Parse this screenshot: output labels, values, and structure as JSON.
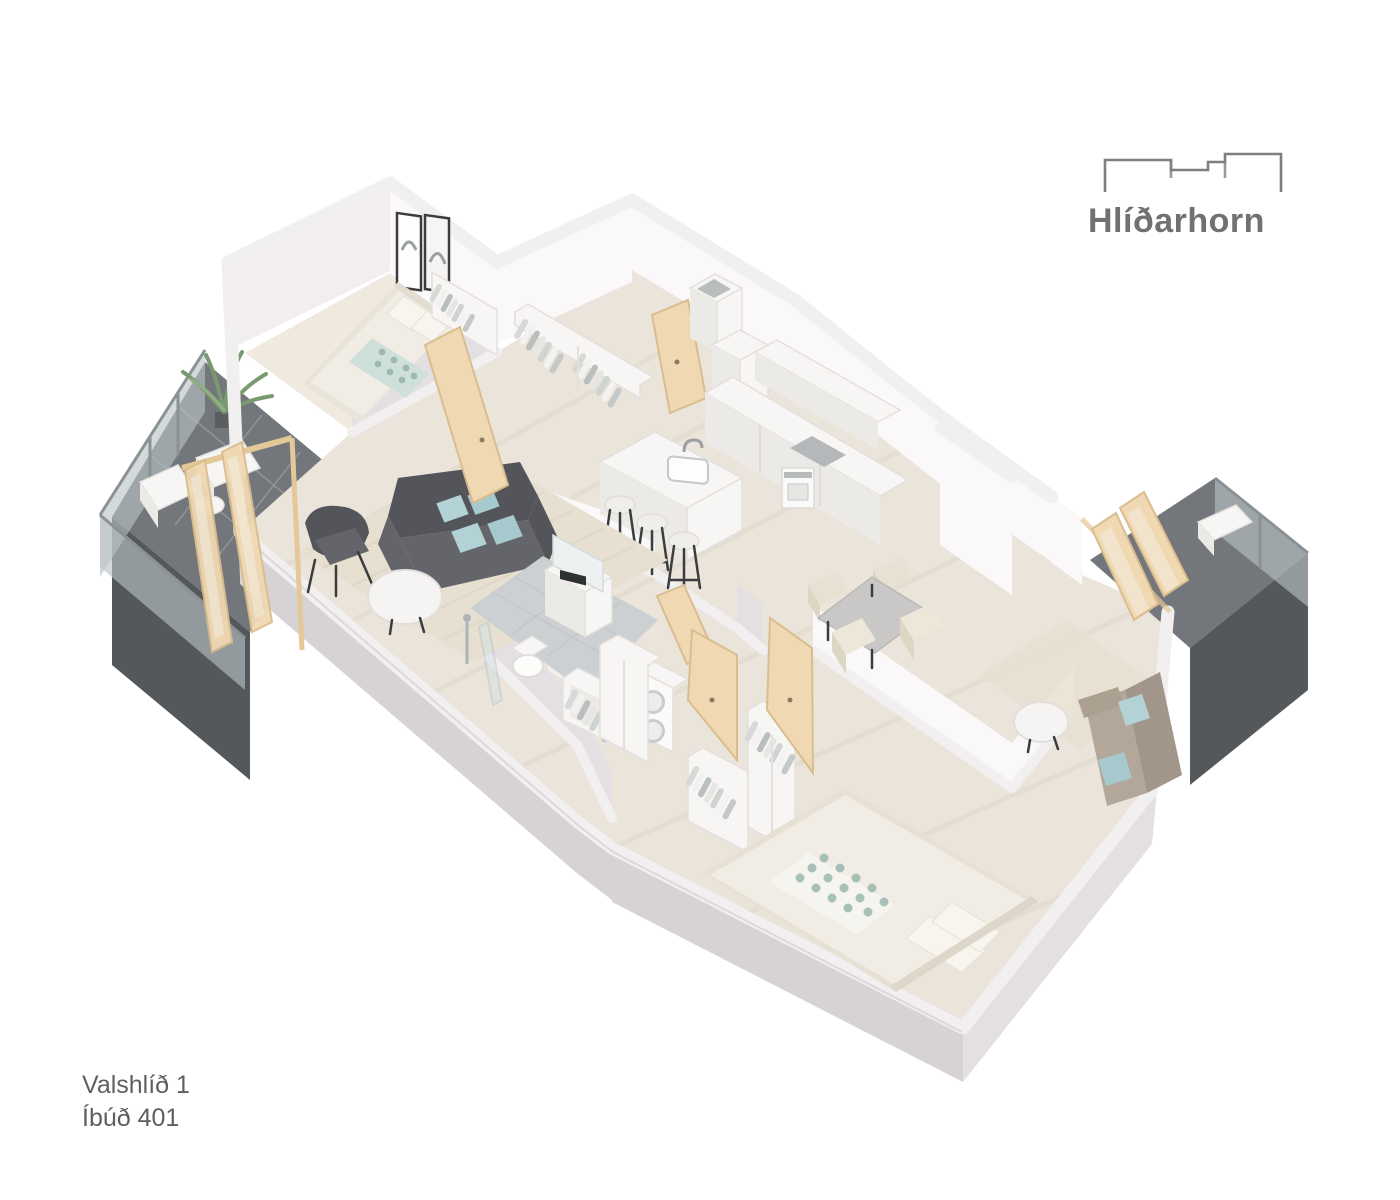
{
  "logo": {
    "brand": "Hlíðarhorn"
  },
  "labels": {
    "project": "Valshlíð 1",
    "unit": "Íbúð 401"
  },
  "plan": {
    "type": "3d-isometric-floor-plan",
    "rooms": [
      "bedroom-1",
      "entry-hall",
      "kitchen",
      "living-room",
      "bathroom",
      "laundry",
      "dining-area",
      "sitting-nook",
      "bedroom-2",
      "balcony-west",
      "balcony-east"
    ],
    "furniture": [
      "double-bed",
      "wall-art",
      "wardrobe",
      "hall-closet",
      "sofa",
      "armchair",
      "coffee-table",
      "area-rug",
      "kitchen-island",
      "sink",
      "bar-stools",
      "counter",
      "oven",
      "cooktop",
      "tall-cabinet",
      "dining-table",
      "dining-chairs",
      "washer-dryer-stack",
      "vanity",
      "mirror",
      "toilet",
      "shower",
      "loveseat",
      "side-table",
      "outdoor-chairs",
      "outdoor-table",
      "plant",
      "lounge-chair"
    ]
  },
  "colors": {
    "background": "#ffffff",
    "logo_gray": "#7a7a7a",
    "label_gray": "#5f5f5f",
    "wall_white": "#f2eff1",
    "floor_wood": "#eae4da",
    "bathroom_tile": "#ccd0d2",
    "balcony_floor": "#73767a",
    "glass_teal": "#b9c3c6",
    "door_tan": "#f0d9b2",
    "sofa_gray": "#63656a",
    "cushion_teal": "#b2d2d6",
    "loveseat_taupe": "#b3a79a",
    "dining_table_gray": "#c9c8c6",
    "chair_cream": "#ece7d8"
  }
}
